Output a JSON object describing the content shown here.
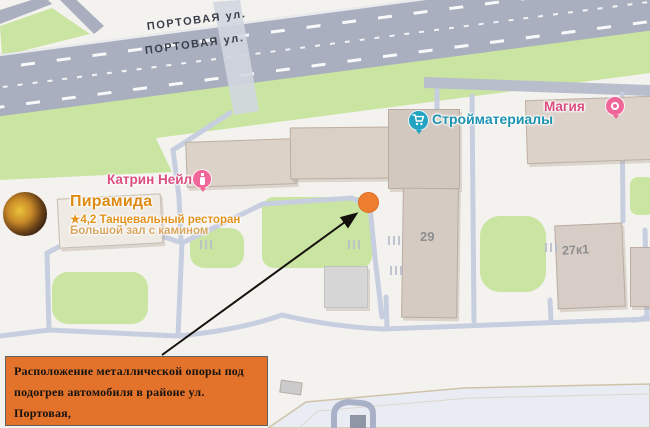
{
  "colors": {
    "annotation_bg": "#E3722B",
    "marker_orange": "#EF7E2E",
    "poi_pink": "#DB4D7F",
    "poi_teal": "#1B93B1",
    "poi_orange": "#DE8A12",
    "road_gray": "#A9AFBE",
    "greenery": "#C9E5A1"
  },
  "street_labels": [
    {
      "text": "ПОРТОВАЯ ул."
    },
    {
      "text": "ПОРТОВАЯ ул."
    }
  ],
  "pois": {
    "katrin": {
      "name": "Катрин Нейл",
      "icon": "nail-polish-icon"
    },
    "stroy": {
      "name": "Стройматериалы",
      "icon": "shopping-cart-icon"
    },
    "magia": {
      "name": "Магия",
      "icon": "cosmetics-icon"
    },
    "piramida": {
      "name": "Пирамида",
      "star": "★",
      "rating": "4,2",
      "category": "Танцевальный ресторан",
      "note": "Большой зал с камином",
      "icon": "photo-avatar"
    }
  },
  "buildings": {
    "b29": "29",
    "b27k1": "27к1"
  },
  "annotation": {
    "text": "Расположение металлической опоры под\nподогрев автомобиля в районе ул. Портовая,\nд. 29, в городе Магадане."
  }
}
